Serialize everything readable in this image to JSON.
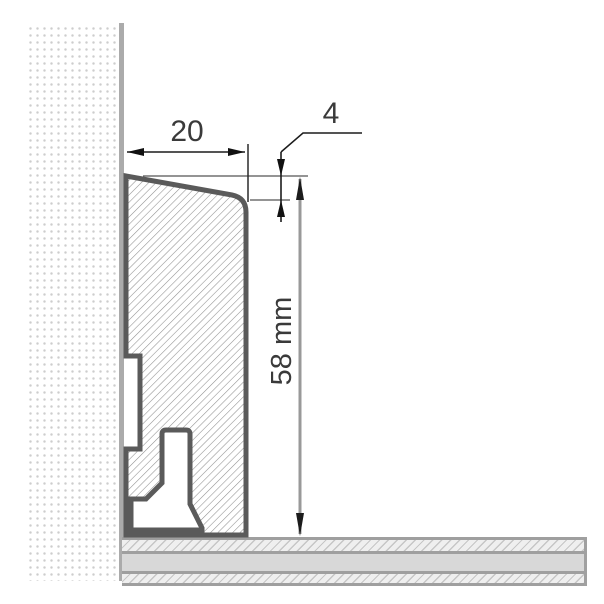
{
  "diagram": {
    "dimensions": {
      "width_label": "20",
      "bevel_label": "4",
      "height_label": "58 mm"
    },
    "colors": {
      "profile_outline": "#5a5a5a",
      "profile_hatch_line": "#8f8f8f",
      "wall_dot": "#cdcdcd",
      "wall_face_line": "#ababab",
      "floor_solid": "#d8d8d8",
      "floor_border": "#a0a0a0",
      "floor_hatch_line": "#c6c6c6",
      "dimension_line_black": "#1c1c1c",
      "dimension_line_gray": "#999999",
      "label_text": "#3a3a3a"
    }
  }
}
